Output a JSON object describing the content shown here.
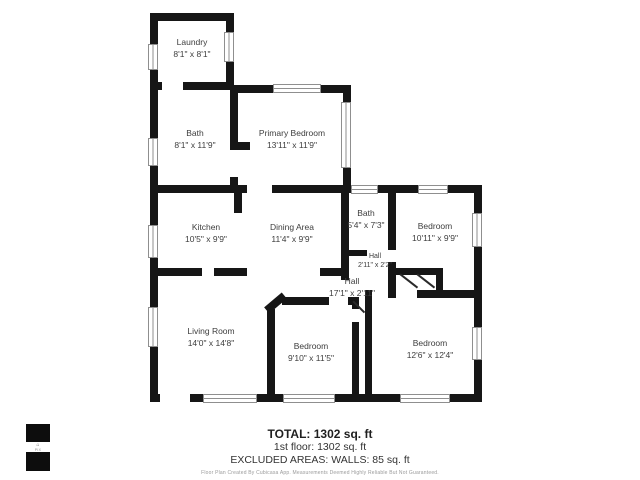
{
  "floor_plan": {
    "rooms": [
      {
        "name": "Laundry",
        "dims": "8'1\" x 8'1\""
      },
      {
        "name": "Bath",
        "dims": "8'1\" x 11'9\""
      },
      {
        "name": "Primary Bedroom",
        "dims": "13'11\" x 11'9\""
      },
      {
        "name": "Kitchen",
        "dims": "10'5\" x 9'9\""
      },
      {
        "name": "Dining Area",
        "dims": "11'4\" x 9'9\""
      },
      {
        "name": "Bath",
        "dims": "5'4\" x 7'3\""
      },
      {
        "name": "Bedroom",
        "dims": "10'11\" x 9'9\""
      },
      {
        "name": "Hall",
        "dims": "2'11\" x 2'2\""
      },
      {
        "name": "Hall",
        "dims": "17'1\" x 2'11\""
      },
      {
        "name": "Living Room",
        "dims": "14'0\" x 14'8\""
      },
      {
        "name": "Bedroom",
        "dims": "9'10\" x 11'5\""
      },
      {
        "name": "Bedroom",
        "dims": "12'6\" x 12'4\""
      }
    ],
    "summary": {
      "total": "TOTAL: 1302 sq. ft",
      "floor": "1st floor: 1302 sq. ft",
      "excluded": "EXCLUDED AREAS: WALLS: 85 sq. ft"
    },
    "disclaimer": "Floor Plan Created By Cubicasa App. Measurements Deemed Highly Reliable But Not Guaranteed.",
    "logo": {
      "text": "PIX"
    },
    "colors": {
      "wall": "#161616",
      "label_text": "#3d3d3d",
      "window_border": "#8f8f8f"
    }
  }
}
